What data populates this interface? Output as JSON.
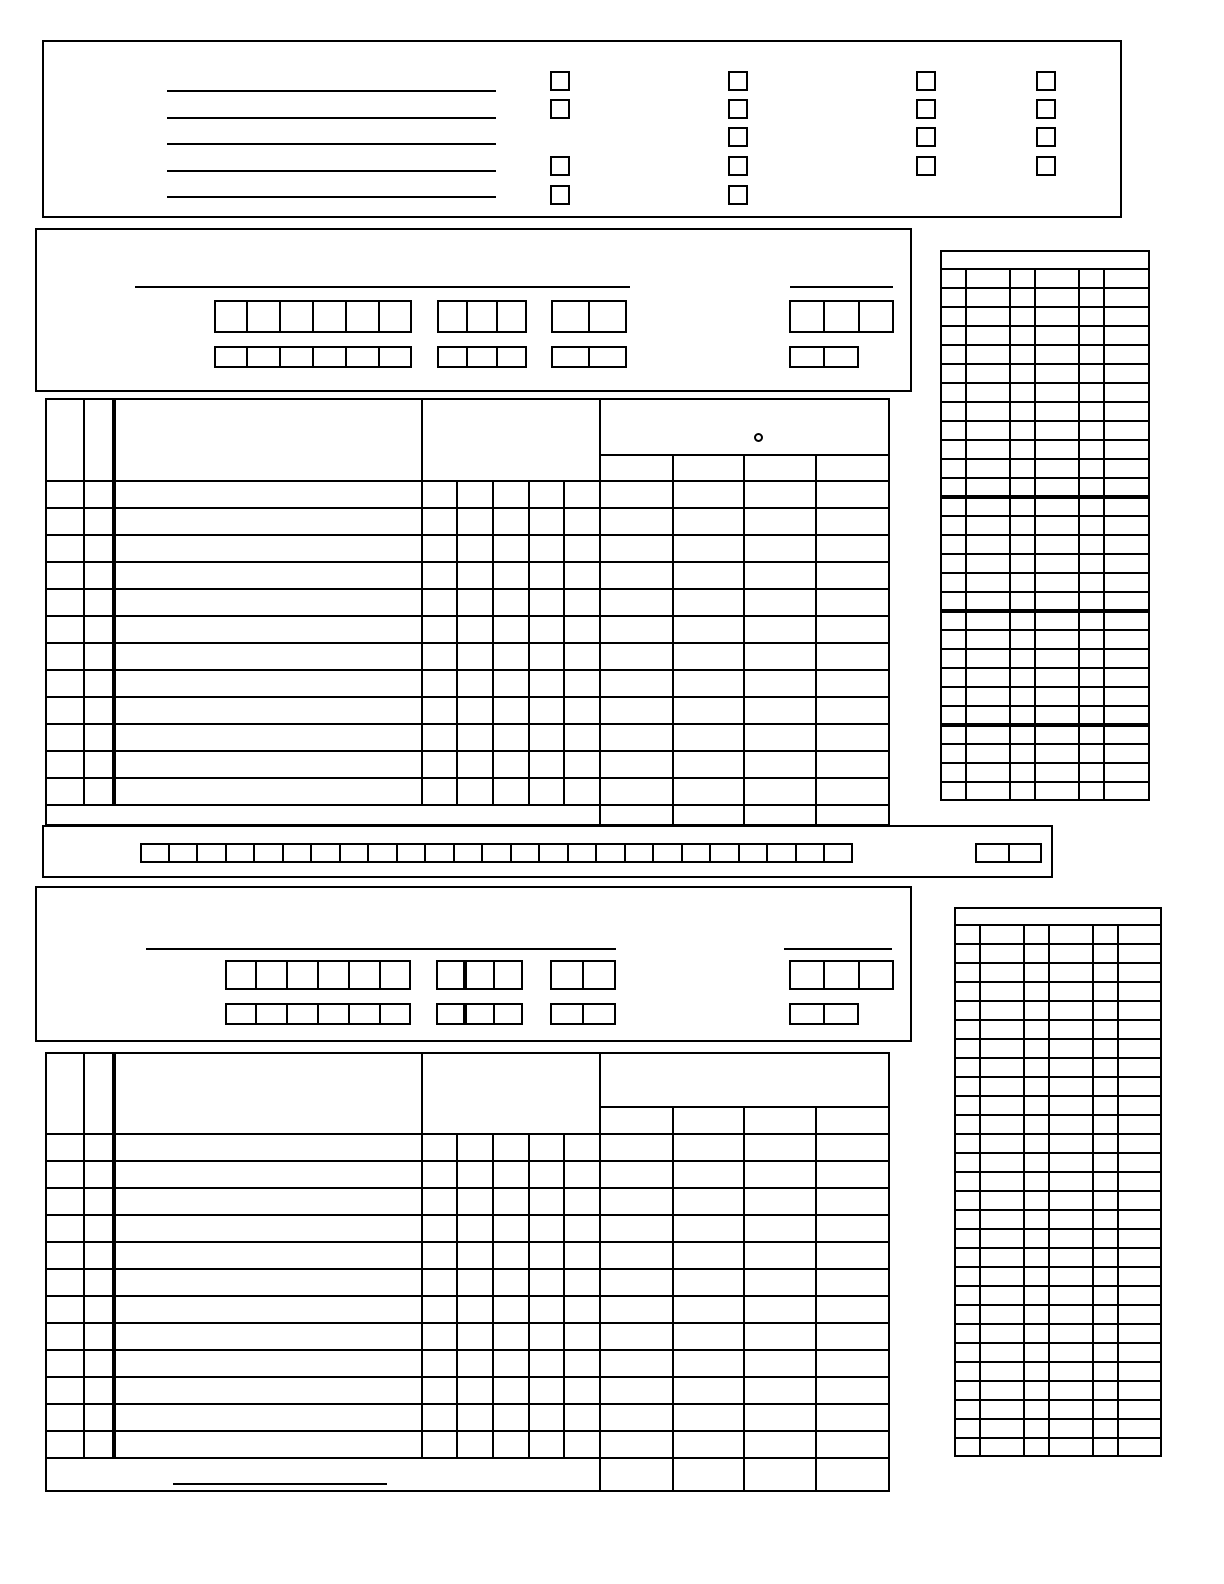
{
  "meta": {
    "document_type": "blank-scoresheet-form",
    "paper_color": "#ffffff",
    "ink_color": "#000000",
    "visible_text": "",
    "icons": {
      "header_marker": "degree-circle-icon"
    }
  },
  "top_panel": {
    "box": {
      "x": 42,
      "y": 40,
      "w": 1080,
      "h": 178
    },
    "write_lines": {
      "x": 167,
      "w": 329,
      "ys": [
        91,
        118,
        144,
        171,
        197
      ]
    },
    "checkbox_size": 20,
    "checkbox_columns": [
      {
        "id": "checkbox-group-1",
        "x": 550,
        "box_tops": [
          71,
          99,
          156,
          185
        ]
      },
      {
        "id": "checkbox-group-2",
        "x": 728,
        "box_tops": [
          71,
          99,
          127,
          156,
          185
        ]
      },
      {
        "id": "checkbox-group-3",
        "x": 916,
        "box_tops": [
          71,
          99,
          127,
          156
        ]
      },
      {
        "id": "checkbox-group-4",
        "x": 1036,
        "box_tops": [
          71,
          99,
          127,
          156
        ]
      }
    ]
  },
  "team_panel_a": {
    "box": {
      "x": 35,
      "y": 228,
      "w": 877,
      "h": 164
    },
    "name_line": {
      "x1": 135,
      "x2": 630,
      "y": 287
    },
    "code_line": {
      "x1": 790,
      "x2": 893,
      "y": 287
    },
    "cell_rows": [
      {
        "y": 300,
        "h": 33,
        "groups": [
          {
            "x": 214,
            "cells": 6,
            "cell_w": 33
          },
          {
            "x": 437,
            "cells": 3,
            "cell_w": 30
          },
          {
            "x": 551,
            "cells": 2,
            "cell_w": 38
          }
        ],
        "right_group": {
          "x": 789,
          "cells": 3,
          "cell_w": 35
        }
      },
      {
        "y": 346,
        "h": 22,
        "groups": [
          {
            "x": 214,
            "cells": 6,
            "cell_w": 33
          },
          {
            "x": 437,
            "cells": 3,
            "cell_w": 30
          },
          {
            "x": 551,
            "cells": 2,
            "cell_w": 38
          }
        ],
        "right_group": {
          "x": 789,
          "cells": 2,
          "cell_w": 35
        }
      }
    ]
  },
  "roster_table_a": {
    "x": 45,
    "y": 398,
    "right": 890,
    "header_h": 83,
    "sub_header_dy": 57,
    "col_edges": {
      "a": 84,
      "b": 114,
      "c": 422
    },
    "mid_edges": [
      422,
      457,
      493,
      529,
      564,
      600
    ],
    "right_edges": [
      600,
      673,
      744,
      816,
      890
    ],
    "rows": 12,
    "row_h": 27,
    "totals_h": 21,
    "header_circle": {
      "cx": 758,
      "cy": 437,
      "d": 9
    }
  },
  "code_strip": {
    "box": {
      "x": 42,
      "y": 825,
      "w": 1011,
      "h": 53
    },
    "cell_row": {
      "x": 140,
      "y": 843,
      "cells": 25,
      "cell_w": 28.5,
      "h": 20
    },
    "right_cells": {
      "x": 975,
      "y": 843,
      "cells": 2,
      "cell_w": 33.5,
      "h": 20
    }
  },
  "team_panel_b": {
    "box": {
      "x": 35,
      "y": 886,
      "w": 877,
      "h": 156
    },
    "name_line": {
      "x1": 146,
      "x2": 616,
      "y": 949
    },
    "code_line": {
      "x1": 784,
      "x2": 892,
      "y": 949
    },
    "cell_rows": [
      {
        "y": 960,
        "h": 30,
        "groups": [
          {
            "x": 225,
            "cells": 6,
            "cell_w": 31
          },
          {
            "x": 436,
            "cells": 3,
            "cell_w": 29,
            "thick_after": 1
          },
          {
            "x": 550,
            "cells": 2,
            "cell_w": 33
          }
        ],
        "right_group": {
          "x": 789,
          "cells": 3,
          "cell_w": 35
        }
      },
      {
        "y": 1003,
        "h": 22,
        "groups": [
          {
            "x": 225,
            "cells": 6,
            "cell_w": 31
          },
          {
            "x": 436,
            "cells": 3,
            "cell_w": 29,
            "thick_after": 1
          },
          {
            "x": 550,
            "cells": 2,
            "cell_w": 33
          }
        ],
        "right_group": {
          "x": 789,
          "cells": 2,
          "cell_w": 35
        }
      }
    ]
  },
  "roster_table_b": {
    "x": 45,
    "y": 1052,
    "right": 890,
    "header_h": 82,
    "sub_header_dy": 55,
    "col_edges": {
      "a": 84,
      "b": 114,
      "c": 422
    },
    "mid_edges": [
      422,
      457,
      493,
      529,
      564,
      600
    ],
    "right_edges": [
      600,
      673,
      744,
      816,
      890
    ],
    "rows": 12,
    "row_h": 27,
    "totals_h": 34,
    "totals_line": {
      "x1": 173,
      "x2": 387,
      "dy_from_bottom": 8
    }
  },
  "score_grid_a": {
    "x": 940,
    "y": 250,
    "col_widths": [
      26,
      44,
      25,
      44,
      25,
      46
    ],
    "header_h": 19,
    "rows": 28,
    "row_h": 19,
    "thick_after_rows": [
      12,
      18,
      24
    ]
  },
  "score_grid_b": {
    "x": 954,
    "y": 907,
    "col_widths": [
      26,
      44,
      25,
      44,
      25,
      44
    ],
    "header_h": 18,
    "rows": 28,
    "row_h": 19,
    "thick_after_rows": []
  }
}
